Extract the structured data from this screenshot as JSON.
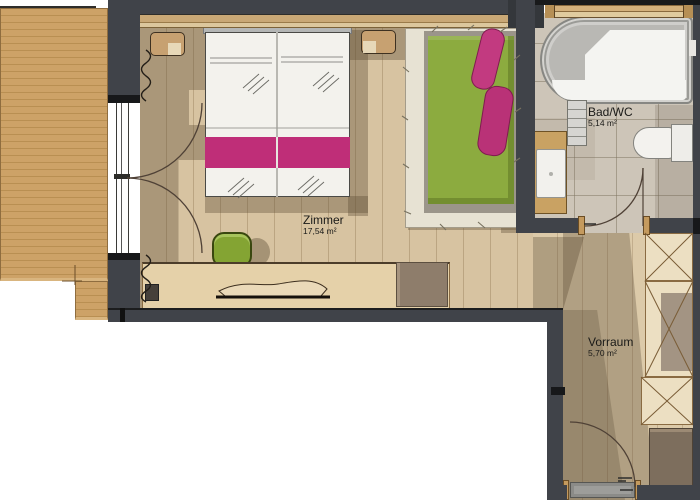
{
  "rooms": [
    {
      "name": "Zimmer",
      "area": "17,54 m²"
    },
    {
      "name": "Bad/WC",
      "area": "5,14 m²"
    },
    {
      "name": "Vorraum",
      "area": "5,70 m²"
    }
  ],
  "colors": {
    "wall": "#404349",
    "room_wood": "#d7c3a1",
    "deck_wood": "#c89c63",
    "bath_tile": "#cdc5b8",
    "bed_accent_pink": "#bf2e78",
    "daybed_green": "#8cab3f",
    "rug": "#e7e2d3"
  }
}
